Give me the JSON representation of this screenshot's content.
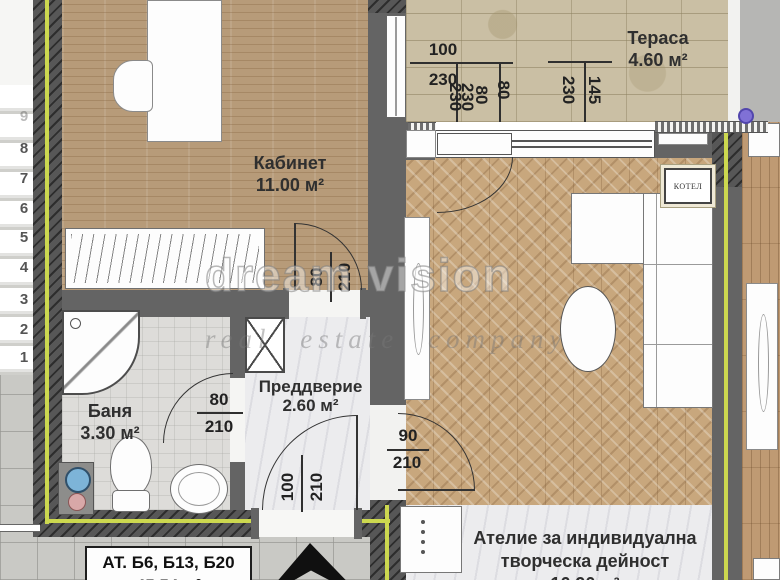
{
  "watermark": {
    "line1": "dream vision",
    "line2": "real estate company"
  },
  "rooms": {
    "kabinet": {
      "name": "Кабинет",
      "area": "11.00 м²"
    },
    "terasa": {
      "name": "Тераса",
      "area": "4.60 м²"
    },
    "banya": {
      "name": "Баня",
      "area": "3.30 м²"
    },
    "preddverie": {
      "name": "Преддверие",
      "area": "2.60 м²"
    },
    "atelie": {
      "name_line1": "Ателие за индивидуална",
      "name_line2": "творческа дейност",
      "area": "16.90 м²"
    }
  },
  "labels": {
    "boiler": "КОТЕЛ",
    "unit_title": "АТ. Б6, Б13, Б20",
    "unit_area": "45.54 м²"
  },
  "dimensions": {
    "terrace": {
      "d100": "100",
      "d230a": "230",
      "d230b": "230",
      "d230c": "230",
      "d80a": "80",
      "d80b": "80",
      "d230d": "230",
      "d145": "145"
    },
    "door_kabinet": {
      "w": "80",
      "h": "210"
    },
    "door_banya": {
      "w": "80",
      "h": "210"
    },
    "door_entry": {
      "w": "100",
      "h": "210"
    },
    "door_atelie": {
      "w": "90",
      "h": "210"
    }
  },
  "stairs": {
    "numbers": [
      "1",
      "2",
      "3",
      "4",
      "5",
      "6",
      "7",
      "8",
      "9"
    ]
  },
  "colors": {
    "accent_line": "#ccd84f",
    "wall": "#646464",
    "wood_floor": "#b79b79",
    "herringbone_floor": "#c8a77d",
    "stone_tile": "#cabfa4",
    "marble": "#ececee",
    "concrete": "#c9c9c5",
    "marker_dot": "#8071d6"
  }
}
